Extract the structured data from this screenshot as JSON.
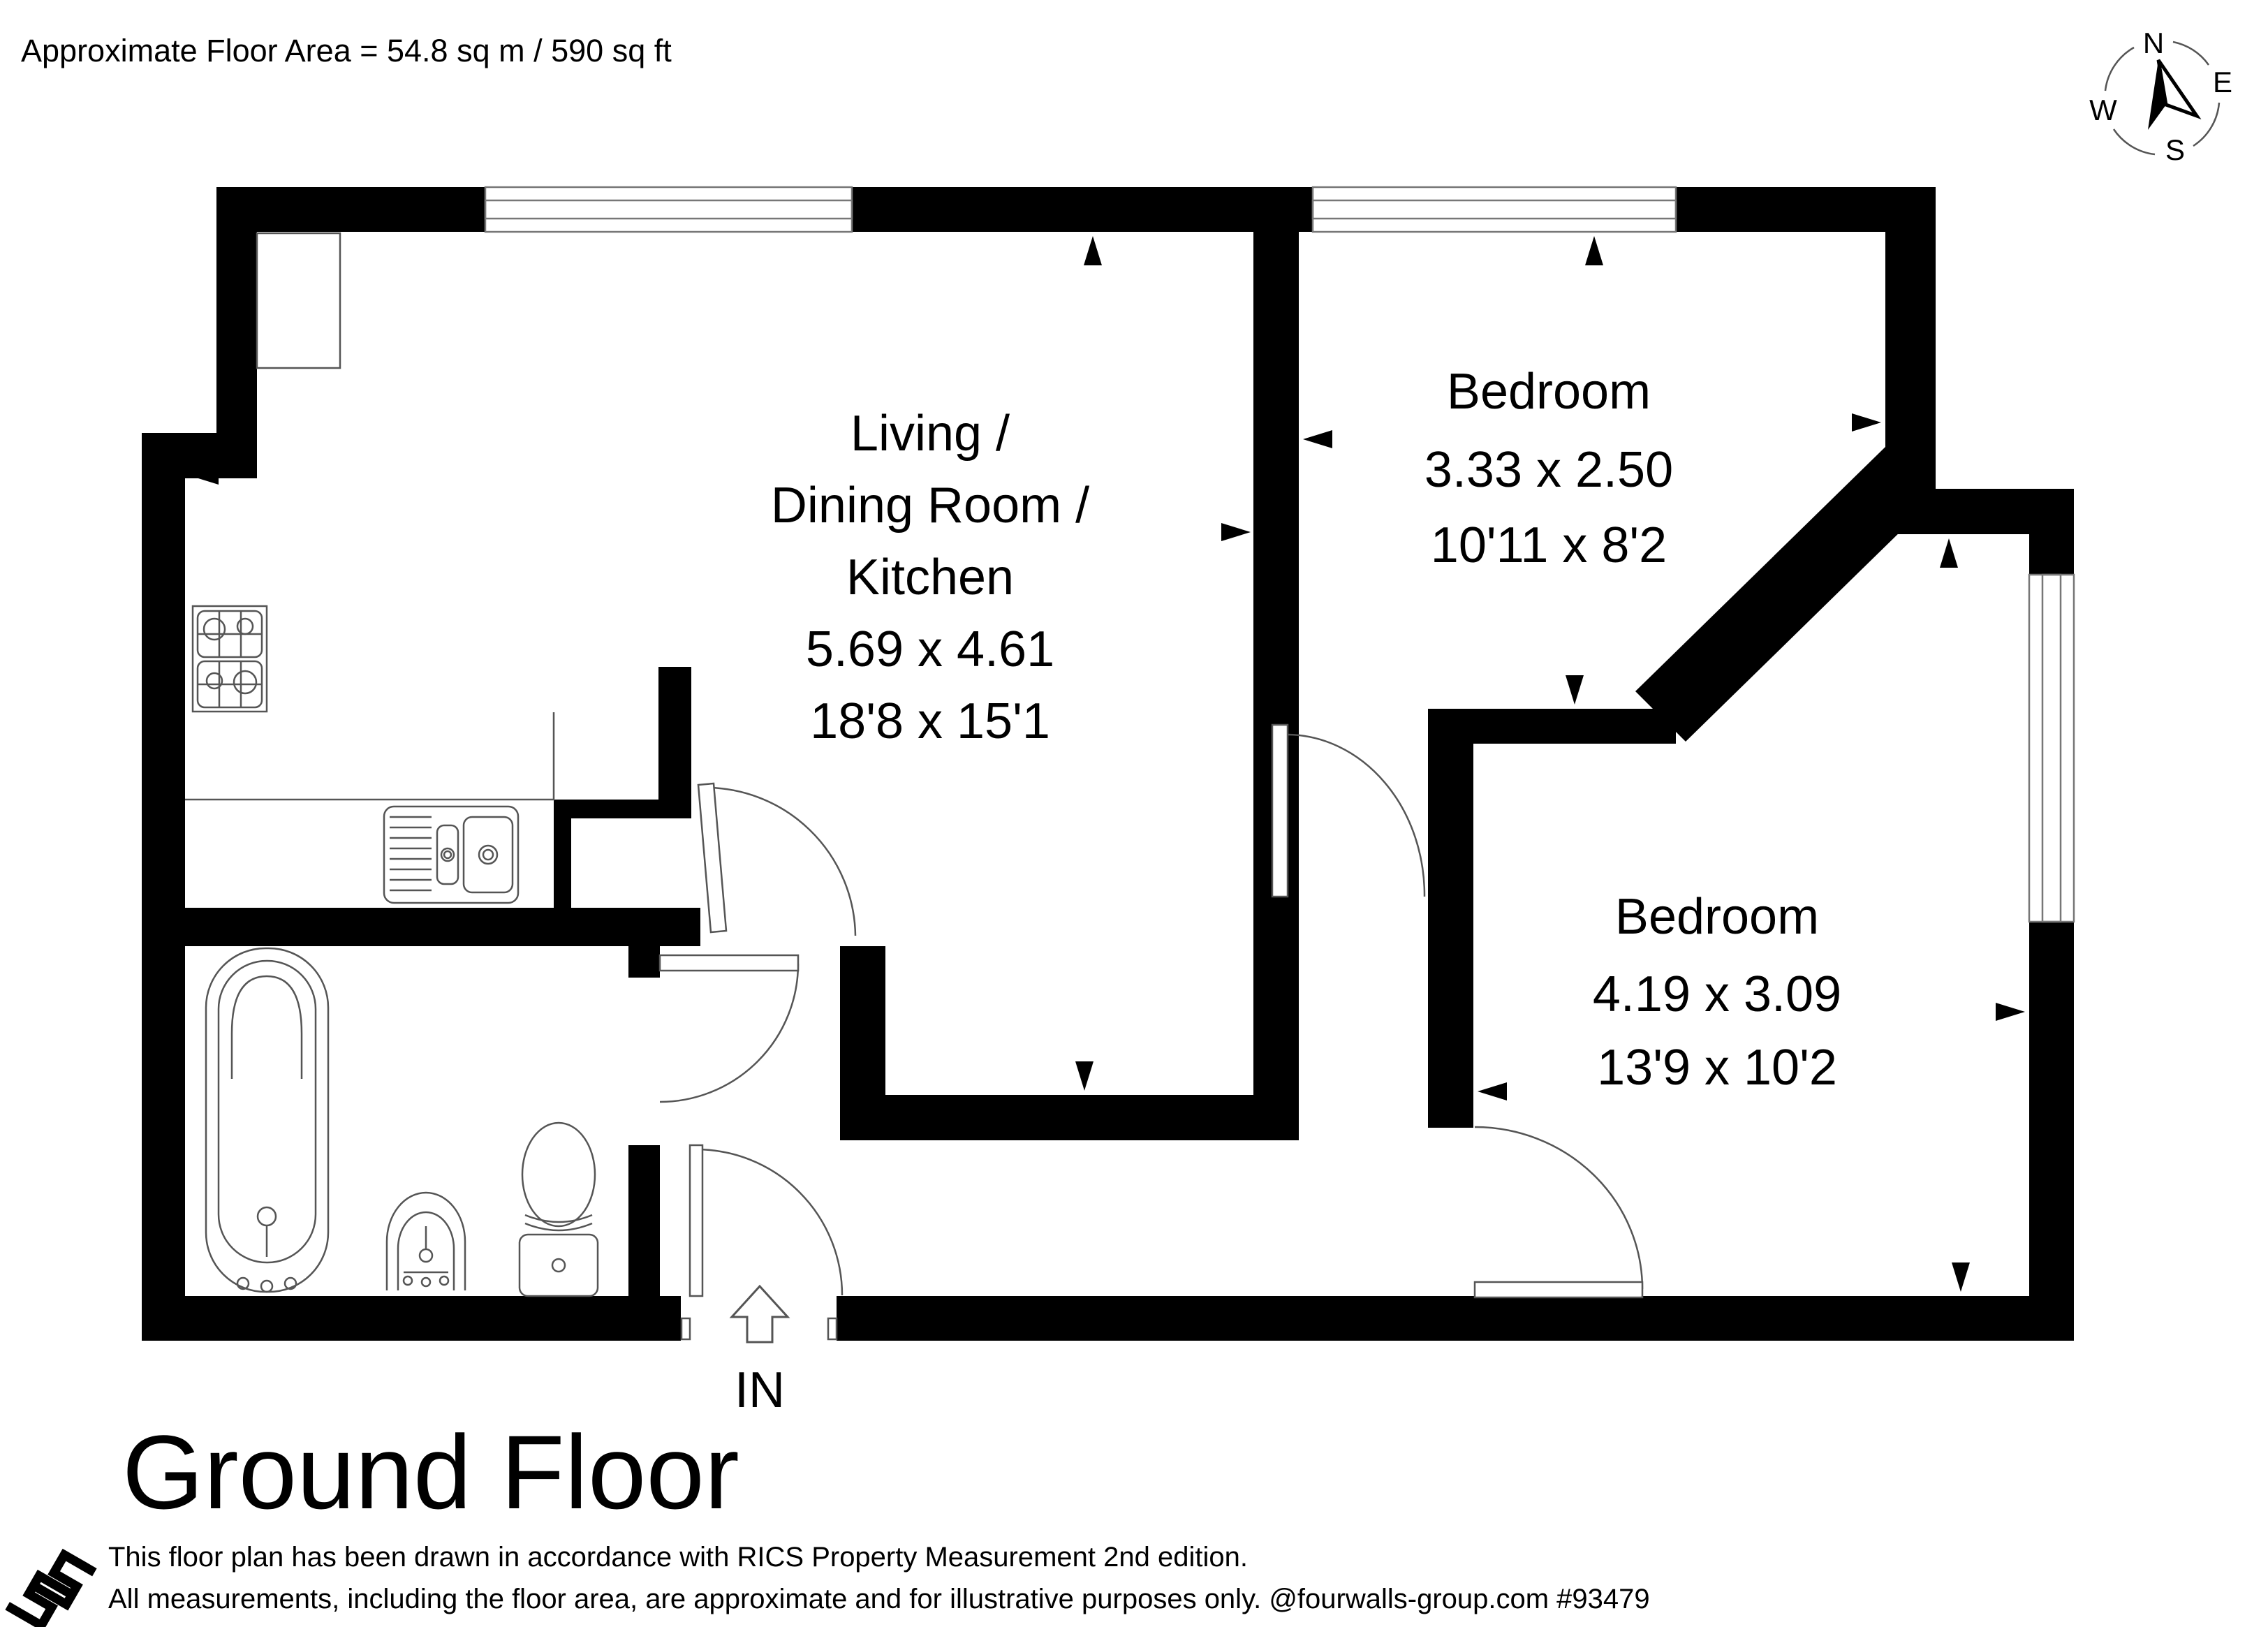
{
  "header": {
    "area": "Approximate Floor Area = 54.8 sq m / 590 sq ft"
  },
  "title": "Ground Floor",
  "entrance": {
    "label": "IN"
  },
  "compass": {
    "n": "N",
    "e": "E",
    "s": "S",
    "w": "W"
  },
  "rooms": {
    "living": {
      "line1": "Living /",
      "line2": "Dining Room /",
      "line3": "Kitchen",
      "metric": "5.69 x 4.61",
      "imperial": "18'8 x 15'1"
    },
    "bedroom1": {
      "name": "Bedroom",
      "metric": "3.33 x 2.50",
      "imperial": "10'11 x 8'2"
    },
    "bedroom2": {
      "name": "Bedroom",
      "metric": "4.19 x 3.09",
      "imperial": "13'9 x 10'2"
    }
  },
  "footer": {
    "line1": "This floor plan has been drawn in accordance with RICS Property Measurement 2nd edition.",
    "line2": "All measurements, including the floor area, are approximate and for illustrative purposes only. @fourwalls-group.com #93479"
  },
  "colors": {
    "wall": "#000000",
    "fixture_line": "#555555",
    "background": "#ffffff"
  }
}
